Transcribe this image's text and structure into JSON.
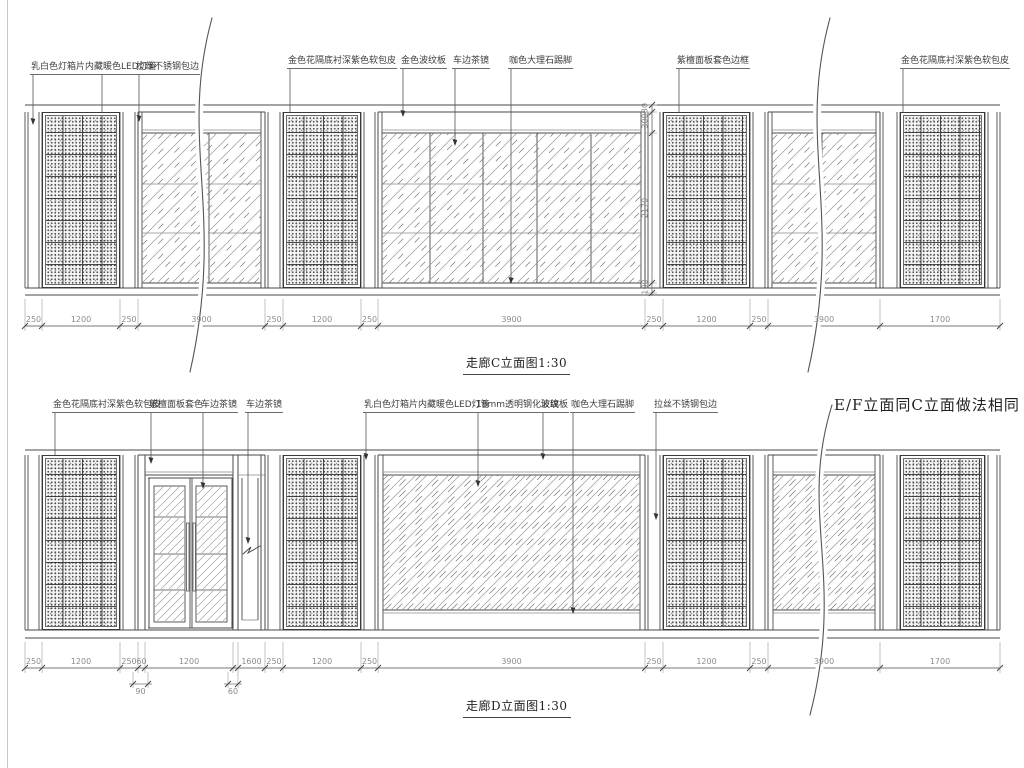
{
  "drawing": {
    "title_c": "走廊C立面图1:30",
    "title_d": "走廊D立面图1:30",
    "note_ef": "E/F立面同C立面做法相同"
  },
  "colors": {
    "line": "#4a4a4a",
    "thin": "#8a8a8a",
    "hatch": "#9a9a9a",
    "hatch2": "#777777",
    "ext": "#aaaaaa",
    "dim_text": "#8c8c8c",
    "label_text": "#3d3d3d"
  },
  "elevation_c": {
    "labels": [
      {
        "t": "乳白色灯箱片内藏暖色LED灯管",
        "x": 30,
        "y": 62,
        "drops": [
          [
            33,
            125
          ],
          [
            102,
            234
          ]
        ]
      },
      {
        "t": "拉丝不锈钢包边",
        "x": 135,
        "y": 62,
        "drops": [
          [
            139,
            122
          ]
        ]
      },
      {
        "t": "金色花隔底衬深紫色软包皮",
        "x": 287,
        "y": 56,
        "drops": [
          [
            290,
            227
          ]
        ]
      },
      {
        "t": "金色波纹板",
        "x": 400,
        "y": 56,
        "drops": [
          [
            403,
            117
          ]
        ]
      },
      {
        "t": "车边茶镜",
        "x": 452,
        "y": 56,
        "drops": [
          [
            455,
            146
          ]
        ]
      },
      {
        "t": "咖色大理石踢脚",
        "x": 508,
        "y": 56,
        "drops": [
          [
            511,
            284
          ]
        ]
      },
      {
        "t": "紫檀面板套色边框",
        "x": 676,
        "y": 56,
        "drops": [
          [
            679,
            124
          ]
        ]
      },
      {
        "t": "金色花隔底衬深紫色软包皮",
        "x": 900,
        "y": 56,
        "drops": [
          [
            903,
            124
          ]
        ]
      }
    ],
    "dims": {
      "y": 326,
      "bounds": [
        25,
        42,
        120,
        138,
        265,
        283,
        361,
        378,
        645,
        663,
        750,
        768,
        880,
        1000
      ],
      "labels": [
        "250",
        "1200",
        "250",
        "3900",
        "250",
        "1200",
        "250",
        "3900",
        "250",
        "1200",
        "250",
        "3900",
        "1700"
      ]
    },
    "vdims": {
      "x": 652,
      "ticks": [
        105,
        112,
        133,
        283,
        293
      ],
      "labels": [
        {
          "t": "30",
          "y": 108
        },
        {
          "t": "300",
          "y": 121
        },
        {
          "t": "2170",
          "y": 208
        },
        {
          "t": "100",
          "y": 287
        }
      ]
    },
    "geom": {
      "top": 105,
      "ptop": 112,
      "band": 133,
      "gbot": 283,
      "pbot": 288,
      "floor": 295,
      "zones": [
        [
          "strip",
          25,
          42
        ],
        [
          "lattice",
          42,
          120
        ],
        [
          "strip",
          120,
          138
        ],
        [
          "glass",
          138,
          265,
          {
            "m": [
              209
            ],
            "rows": [
              184,
              233
            ]
          }
        ],
        [
          "strip",
          265,
          283
        ],
        [
          "lattice",
          283,
          361
        ],
        [
          "strip",
          361,
          378
        ],
        [
          "glass",
          378,
          645,
          {
            "m": [
              430,
              483,
              537,
              591
            ],
            "rows": [
              184,
              233
            ]
          }
        ],
        [
          "strip",
          645,
          663
        ],
        [
          "lattice",
          663,
          750
        ],
        [
          "strip",
          750,
          768
        ],
        [
          "glass",
          768,
          880,
          {
            "m": [
              822
            ],
            "rows": [
              184,
              233
            ]
          }
        ],
        [
          "strip",
          880,
          900
        ],
        [
          "lattice",
          900,
          985
        ],
        [
          "strip",
          985,
          1000
        ]
      ]
    },
    "wavys": [
      {
        "x": 200,
        "y0": 18,
        "y1": 372
      },
      {
        "x": 818,
        "y0": 18,
        "y1": 372
      }
    ]
  },
  "elevation_d": {
    "labels": [
      {
        "t": "金色花隔底衬深紫色软包皮",
        "x": 52,
        "y": 400,
        "drops": [
          [
            55,
            467
          ]
        ]
      },
      {
        "t": "紫檀面板套色",
        "x": 148,
        "y": 400,
        "drops": [
          [
            151,
            464
          ]
        ]
      },
      {
        "t": "车边茶镜",
        "x": 200,
        "y": 400,
        "drops": [
          [
            203,
            489
          ]
        ]
      },
      {
        "t": "车边茶镜",
        "x": 245,
        "y": 400,
        "drops": [
          [
            248,
            544
          ]
        ]
      },
      {
        "t": "乳白色灯箱片内藏暖色LED灯管",
        "x": 363,
        "y": 400,
        "drops": [
          [
            366,
            460
          ]
        ]
      },
      {
        "t": "18mm透明钢化玻璃",
        "x": 475,
        "y": 400,
        "drops": [
          [
            478,
            487
          ]
        ]
      },
      {
        "t": "波纹板",
        "x": 540,
        "y": 400,
        "drops": [
          [
            543,
            460
          ]
        ]
      },
      {
        "t": "咖色大理石踢脚",
        "x": 570,
        "y": 400,
        "drops": [
          [
            573,
            614
          ]
        ]
      },
      {
        "t": "拉丝不锈钢包边",
        "x": 653,
        "y": 400,
        "drops": [
          [
            656,
            520
          ]
        ]
      }
    ],
    "dims": {
      "y": 668,
      "bounds": [
        25,
        42,
        120,
        138,
        145,
        233,
        238,
        265,
        283,
        361,
        378,
        645,
        663,
        750,
        768,
        880,
        1000
      ],
      "labels": [
        "250",
        "1200",
        "250",
        "60",
        "1200",
        "",
        "1600",
        "250",
        "1200",
        "250",
        "3900",
        "250",
        "1200",
        "250",
        "3900",
        "1700"
      ]
    },
    "subdims": [
      {
        "x0": 133,
        "x1": 148,
        "t": "90"
      },
      {
        "x0": 228,
        "x1": 238,
        "t": "60"
      }
    ],
    "geom": {
      "top": 450,
      "ptop": 455,
      "band": 475,
      "gbot": 610,
      "pbot": 630,
      "floor": 638,
      "zones": [
        [
          "strip",
          25,
          42
        ],
        [
          "lattice",
          42,
          120
        ],
        [
          "strip",
          120,
          138
        ],
        [
          "door",
          138,
          265
        ],
        [
          "strip",
          265,
          283
        ],
        [
          "lattice",
          283,
          361
        ],
        [
          "strip",
          361,
          378
        ],
        [
          "glassd",
          378,
          645
        ],
        [
          "strip",
          645,
          663
        ],
        [
          "lattice",
          663,
          750
        ],
        [
          "strip",
          750,
          768
        ],
        [
          "glassd",
          768,
          880
        ],
        [
          "strip",
          880,
          900
        ],
        [
          "lattice",
          900,
          985
        ],
        [
          "strip",
          985,
          1000
        ]
      ]
    },
    "wavys": [
      {
        "x": 820,
        "y0": 405,
        "y1": 715
      }
    ]
  }
}
